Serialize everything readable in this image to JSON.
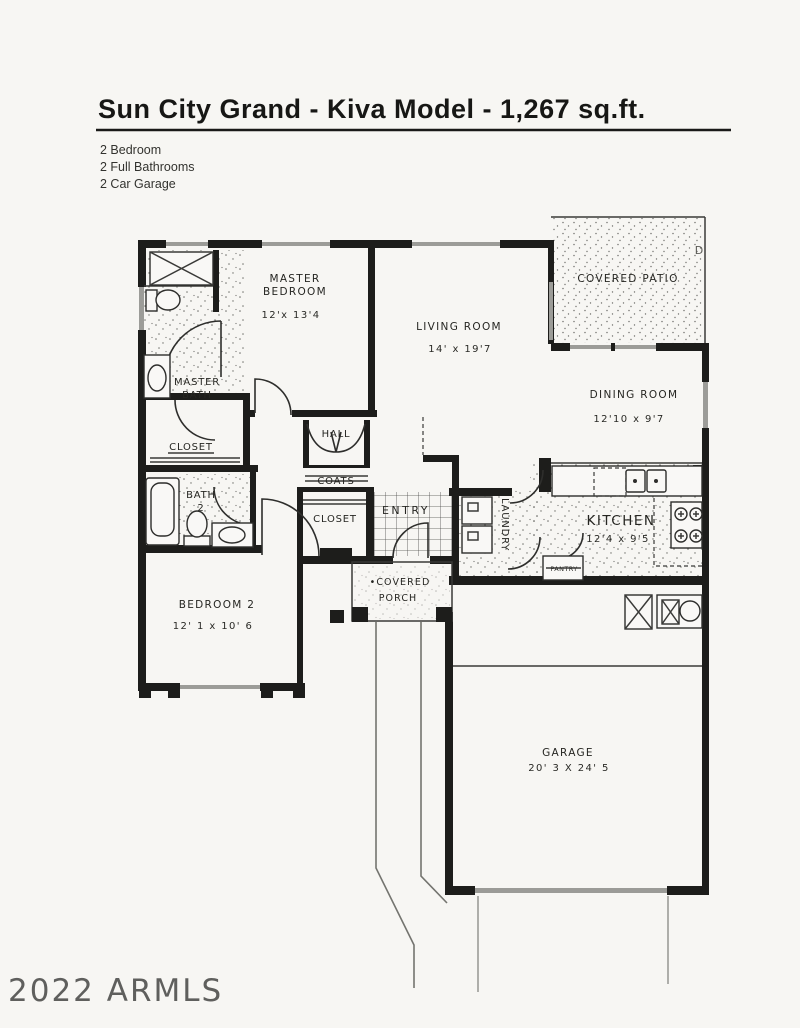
{
  "header": {
    "title": "Sun City Grand - Kiva Model - 1,267 sq.ft.",
    "features": [
      "2 Bedroom",
      "2 Full Bathrooms",
      "2 Car Garage"
    ]
  },
  "watermark": "2022 ARMLS",
  "plan": {
    "rooms": {
      "master_bedroom": {
        "line1": "MASTER",
        "line2": "BEDROOM",
        "dims": "12'x 13'4"
      },
      "living_room": {
        "name": "LIVING ROOM",
        "dims": "14' x 19'7"
      },
      "covered_patio": {
        "name": "COVERED PATIO"
      },
      "dining_room": {
        "name": "DINING ROOM",
        "dims": "12'10 x 9'7"
      },
      "kitchen": {
        "name": "KITCHEN",
        "dims": "12'4 x 9'5"
      },
      "laundry": {
        "name": "LAUNDRY"
      },
      "pantry": {
        "name": "PANTRY"
      },
      "entry": {
        "name": "ENTRY"
      },
      "hall": {
        "name": "HALL"
      },
      "coats": {
        "name": "COATS"
      },
      "entry_closet": {
        "name": "CLOSET"
      },
      "master_bath": {
        "line1": "MASTER",
        "line2": "BATH"
      },
      "master_closet": {
        "name": "CLOSET"
      },
      "bath_2": {
        "line1": "BATH",
        "line2": "2"
      },
      "bedroom_2": {
        "name": "BEDROOM 2",
        "dims": "12' 1 x 10' 6"
      },
      "covered_porch": {
        "line1": "•COVERED",
        "line2": "PORCH"
      },
      "garage": {
        "name": "GARAGE",
        "dims": "20' 3 X 24' 5"
      }
    },
    "annotations": {
      "patio_letter": "D"
    },
    "colors": {
      "wall": "#1d1d1b",
      "window_gray": "#9c9c98",
      "garage_door_gray": "#9b9b97"
    }
  }
}
